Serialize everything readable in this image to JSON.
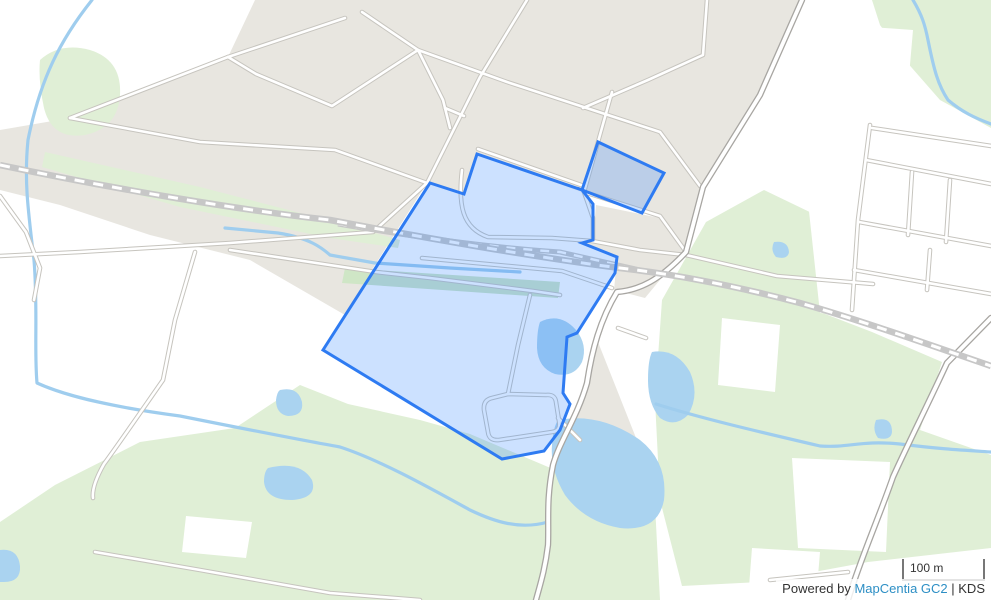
{
  "ui": {
    "scalebar": {
      "label": "100 m"
    },
    "attribution": {
      "prefix": "Powered by ",
      "link_text": "MapCentia GC2",
      "rest": " | KDS"
    }
  },
  "map": {
    "colors": {
      "background": "#ffffff",
      "urban": "#e8e6e0",
      "green": "#e0efd6",
      "green_dark": "#cfe6c6",
      "water": "#aad3f0",
      "road_casing": "#c6c4be",
      "road_major_casing": "#a8a6a2",
      "railway": "#c7c7c7",
      "highlight_stroke": "#2e7bf2",
      "highlight_fill": "#3388ff",
      "attribution_link": "#2d8fc5"
    },
    "features": {
      "urban": [
        "M 255,0 L 802,0 L 760,95 L 700,190 L 686,252 L 660,216 L 582,192 L 477,155 L 464,194 L 427,183 L 375,265 L 345,315 L 250,260 L 150,235 L 60,205 L 0,190 L 0,130 L 70,118 L 228,57 Z",
        "M 596,205 L 660,218 L 683,252 L 645,298 L 614,290 L 617,258 L 584,244 L 593,240 Z",
        "M 598,342 L 640,448 L 612,494 L 558,472 L 572,420 L 588,384 Z",
        "M 528,548 L 578,556 L 572,600 L 508,600 Z",
        "M 506,478 L 540,482 L 536,512 L 504,506 Z",
        "M 806,505 L 858,508 L 853,555 L 800,550 Z"
      ],
      "green": [
        "M 40,60 Q 60,42 90,50 Q 122,60 120,95 Q 118,128 85,135 Q 52,140 44,108 Q 38,80 40,60 Z",
        "M 872,0 L 991,0 L 991,128 L 940,100 L 905,60 L 880,25 Z",
        "M 45,152 L 200,187 L 335,222 L 400,240 L 398,248 L 330,238 L 180,207 L 42,167 Z",
        "M 706,222 L 764,190 L 818,216 L 820,312 L 872,332 L 942,362 L 920,430 L 991,455 L 991,548 L 868,562 L 760,582 L 682,586 L 660,500 L 655,400 L 662,300 Z",
        "M 55,485 L 140,442 L 235,428 L 300,385 L 348,404 L 420,420 L 470,434 L 560,472 L 655,505 L 660,600 L 0,600 L 0,522 Z"
      ],
      "green_dark": [
        "M 345,268 L 560,282 L 558,298 L 342,283 Z"
      ],
      "white_patches": [
        "M 843,25 L 913,30 L 908,88 L 838,80 Z",
        "M 800,128 L 991,150 L 991,328 L 820,313 Z",
        "M 722,318 L 780,325 L 775,392 L 718,385 Z",
        "M 792,458 L 890,462 L 886,552 L 798,548 Z",
        "M 752,548 L 820,552 L 816,600 L 748,600 Z",
        "M 948,368 L 991,358 L 991,398 L 952,400 Z",
        "M 186,516 L 252,522 L 246,558 L 182,552 Z"
      ],
      "water_areas": [
        "M 540,322 Q 560,312 576,330 Q 588,345 582,362 Q 574,378 555,374 Q 538,368 537,348 Q 537,330 540,322 Z",
        "M 558,420 Q 600,412 640,440 Q 668,462 664,500 Q 658,532 620,528 Q 585,522 565,495 Q 550,470 552,445 Q 553,428 558,420 Z",
        "M 280,390 Q 298,386 302,402 Q 304,416 288,416 Q 276,414 276,400 Q 277,392 280,390 Z",
        "M 268,468 Q 300,460 312,480 Q 318,498 292,500 Q 266,500 264,482 Q 264,472 268,468 Z",
        "M 0,550 Q 18,548 20,566 Q 21,582 4,582 L 0,582 Z",
        "M 876,420 Q 892,416 892,432 Q 891,441 878,438 Q 872,430 876,420 Z",
        "M 774,242 Q 788,240 789,252 Q 788,260 776,257 Q 770,250 774,242 Z",
        "M 652,352 Q 676,348 690,372 Q 700,395 688,415 Q 675,428 660,418 Q 648,404 648,380 Q 648,360 652,352 Z"
      ],
      "water_lines": [
        "M 92,0 C 60,40 40,80 28,140 C 24,180 28,210 34,260 C 38,310 34,350 37,383 C 70,398 120,408 180,416 C 240,428 300,440 340,447 C 380,460 430,488 470,510 C 495,522 520,530 548,522",
        "M 656,404 C 700,418 760,432 820,446 C 850,448 860,440 900,444 C 940,449 960,450 991,452",
        "M 913,0 C 922,15 925,25 928,40 C 934,70 938,85 948,100 C 962,112 975,118 991,124",
        "M 225,228 L 278,233 C 310,238 322,248 330,255 L 375,263 L 450,268 L 520,272"
      ],
      "roads_thin": [
        "M 70,118 L 228,57 L 345,18",
        "M 228,57 L 256,74 L 332,106 L 418,50",
        "M 70,118 L 200,142 L 335,150 L 427,183",
        "M 362,12 L 418,50 L 507,82 L 660,132 L 700,186",
        "M 418,50 L 443,100 L 450,128",
        "M 445,108 L 464,116",
        "M 583,108 L 648,80 L 703,55 L 707,0",
        "M 527,0 L 480,77 L 427,183 L 373,232 L 230,243 L 80,252 L 0,256",
        "M 230,250 L 376,272 L 430,278 L 533,291 L 560,295",
        "M 195,252 L 175,320 L 163,380 C 140,413 118,445 104,464 C 96,478 92,490 93,498",
        "M 0,196 L 26,232 L 40,268 L 34,300",
        "M 462,170 C 458,205 462,228 488,237 L 552,238 L 592,241",
        "M 592,241 L 640,250 L 686,255",
        "M 422,258 L 562,271 L 612,288",
        "M 478,149 L 584,186",
        "M 530,295 L 518,345 L 508,394",
        "M 508,394 L 492,398 Q 483,400 484,410 L 488,432 Q 489,441 499,440 L 552,432 Q 561,431 559,421 L 556,402 Q 555,394 546,395 L 508,394",
        "M 558,418 L 580,440",
        "M 584,192 L 660,216 L 686,252",
        "M 612,92 L 598,142 L 584,192",
        "M 584,192 L 593,218 L 593,241",
        "M 870,125 L 858,220 L 852,310",
        "M 872,128 L 991,146",
        "M 866,160 L 991,184",
        "M 859,222 L 991,246",
        "M 854,270 L 991,294",
        "M 912,172 L 908,235",
        "M 950,180 L 946,242",
        "M 930,250 L 927,290",
        "M 686,255 L 777,276 L 873,284",
        "M 618,328 L 646,338",
        "M 770,580 L 848,572",
        "M 95,552 L 200,570 L 330,593 L 420,600"
      ],
      "roads_major": [
        "M 802,0 L 760,95 L 703,187 L 686,252 C 660,280 640,290 617,292 C 600,320 592,350 587,383 C 577,418 560,440 553,465 C 546,500 549,520 548,545 C 545,570 540,585 536,600",
        "M 991,318 L 947,363 C 930,400 905,450 893,477 C 878,520 860,560 848,600"
      ],
      "railway_main": "M 0,165 C 120,190 240,210 330,220 C 420,237 540,258 620,268 C 680,275 740,287 800,303 C 860,320 930,345 991,366",
      "railway_branch": "M 338,224 C 420,238 500,248 560,252 L 640,270",
      "highlight": "M 323,350 L 430,183 L 464,194 L 477,154 L 582,190 L 598,142 L 664,173 L 642,213 L 582,190 L 593,204 L 593,240 L 582,243 L 617,257 L 615,273 L 577,333 L 567,337 L 563,393 L 570,404 L 560,430 L 544,451 L 502,459 Z"
    }
  }
}
